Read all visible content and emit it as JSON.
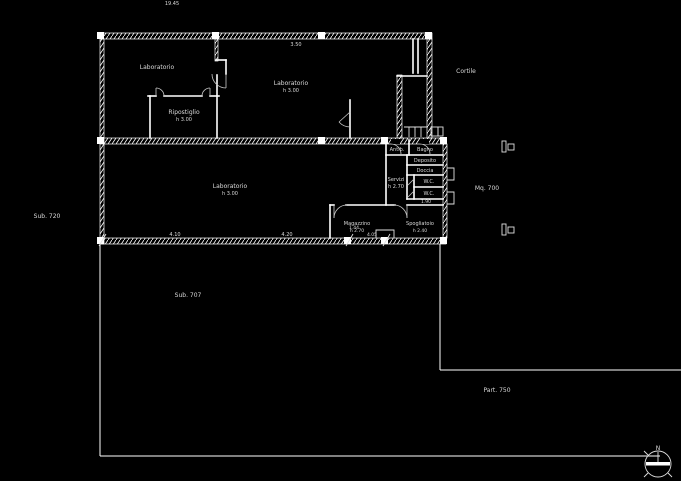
{
  "plan": {
    "colors": {
      "background": "#000000",
      "line": "#ffffff",
      "text": "#d9d9d9"
    },
    "dimensions": {
      "top": "19.45",
      "top_wall": "3.50",
      "bottom_1": "4.10",
      "bottom_2": "4.20",
      "bottom_3": "1.44",
      "bottom_4": "4.05",
      "cluster": "1.90"
    },
    "rooms": {
      "lab_nw": {
        "name": "Laboratorio"
      },
      "ripostiglio": {
        "name": "Ripostiglio",
        "height": "h 3.00"
      },
      "lab_ne": {
        "name": "Laboratorio",
        "height": "h 3.00"
      },
      "lab_main": {
        "name": "Laboratorio",
        "height": "h 3.00"
      },
      "antibagno": {
        "name": "Antib."
      },
      "bagno": {
        "name": "Bagno"
      },
      "deposito": {
        "name": "Deposito"
      },
      "doccia": {
        "name": "Doccia"
      },
      "servizi": {
        "name": "Servizi",
        "height": "h 2.70"
      },
      "wc1": {
        "name": "W.C."
      },
      "wc2": {
        "name": "W.C."
      },
      "magazzino": {
        "name": "Magazzino",
        "height": "h 2.70"
      },
      "spogliatoio": {
        "name": "Spogliatoio",
        "height": "h 2.40"
      }
    },
    "site": {
      "cortile": "Cortile",
      "mq": "Mq. 700",
      "sub_left": "Sub. 720",
      "sub_yard": "Sub. 707",
      "part_right": "Part. 750"
    },
    "compass": {
      "north": "N"
    }
  }
}
